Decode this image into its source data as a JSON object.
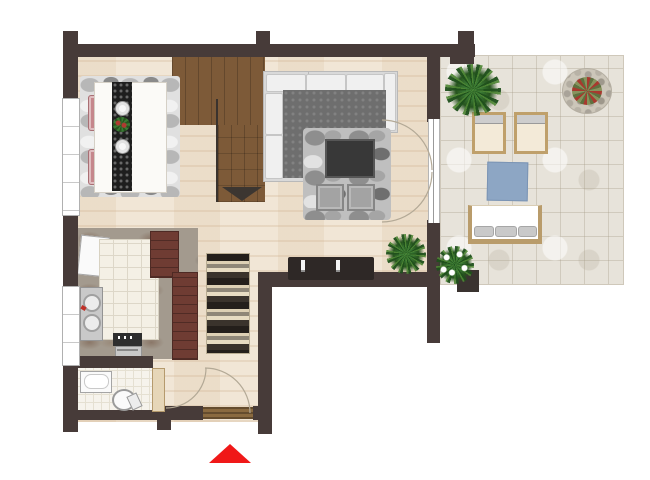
{
  "meta": {
    "view": "apartment-floor-plan-top-view",
    "canvas": {
      "width": 650,
      "height": 480
    }
  },
  "colors": {
    "wall": "#473b39",
    "wood_floor": "#f1e6d6",
    "stair_wood": "#7d5a38",
    "stair_arrow": "#3c3631",
    "terrace_tile": "#e7e3da",
    "window": "#ffffff",
    "window_frame": "#b0b0b0",
    "door_arc": "#b3a996",
    "door_leaf": "#e6d6b8",
    "entry_mat": "#8a6a40",
    "dining_rug": "#e0e0e0",
    "runner_dark": "#1e1e1e",
    "chair_pink": "#c5878c",
    "sofa_base": "#d9d9d9",
    "sofa_cushion": "#f0f0f0",
    "sofa_seat": "#6e6e6e",
    "living_rug": "#bfbfbf",
    "coffee_table": "#383838",
    "pouf": "#a3a3a3",
    "sideboard": "#2e2826",
    "kitchen_marble": "#a39a8e",
    "island_tile": "#f4f0e5",
    "cabinet_maroon": "#6f3c33",
    "steel": "#c9c9c9",
    "bath_tile": "#f6f3ec",
    "blue_mat": "#8da6c4",
    "lounger_wood": "#bfa06b",
    "lounger_cushion": "#f3ead8",
    "plant_green": "#3a7a34",
    "plant_dark": "#27541f",
    "flower_red": "#a8392e",
    "pot_dark": "#3a3330",
    "entrance_marker_red": "#f01818"
  },
  "inventory": {
    "rooms": [
      "living-room",
      "dining-area",
      "kitchen",
      "bathroom",
      "hallway",
      "staircase",
      "terrace"
    ],
    "dining": [
      "pebble-rug",
      "dining-table",
      "table-runner",
      "2-plates",
      "centerpiece-plant",
      "4-pink-chairs"
    ],
    "living": [
      "l-shaped-sofa",
      "pebble-rug",
      "coffee-table",
      "2-poufs",
      "sideboard",
      "2-candles",
      "potted-plant"
    ],
    "kitchen": [
      "tiled-island",
      "double-sink",
      "fridge",
      "maroon-cabinets",
      "stove-oven"
    ],
    "bathroom": [
      "bathtub",
      "toilet"
    ],
    "terrace": [
      "2-sun-loungers",
      "blue-mat",
      "bench-with-cushions",
      "palm-plant",
      "round-flower-planter",
      "white-flower-plant",
      "dark-pot"
    ],
    "markers": [
      "staircase-down-arrow",
      "entrance-triangle-marker",
      "door-swing-arcs",
      "2-windows",
      "entry-doormat"
    ]
  }
}
